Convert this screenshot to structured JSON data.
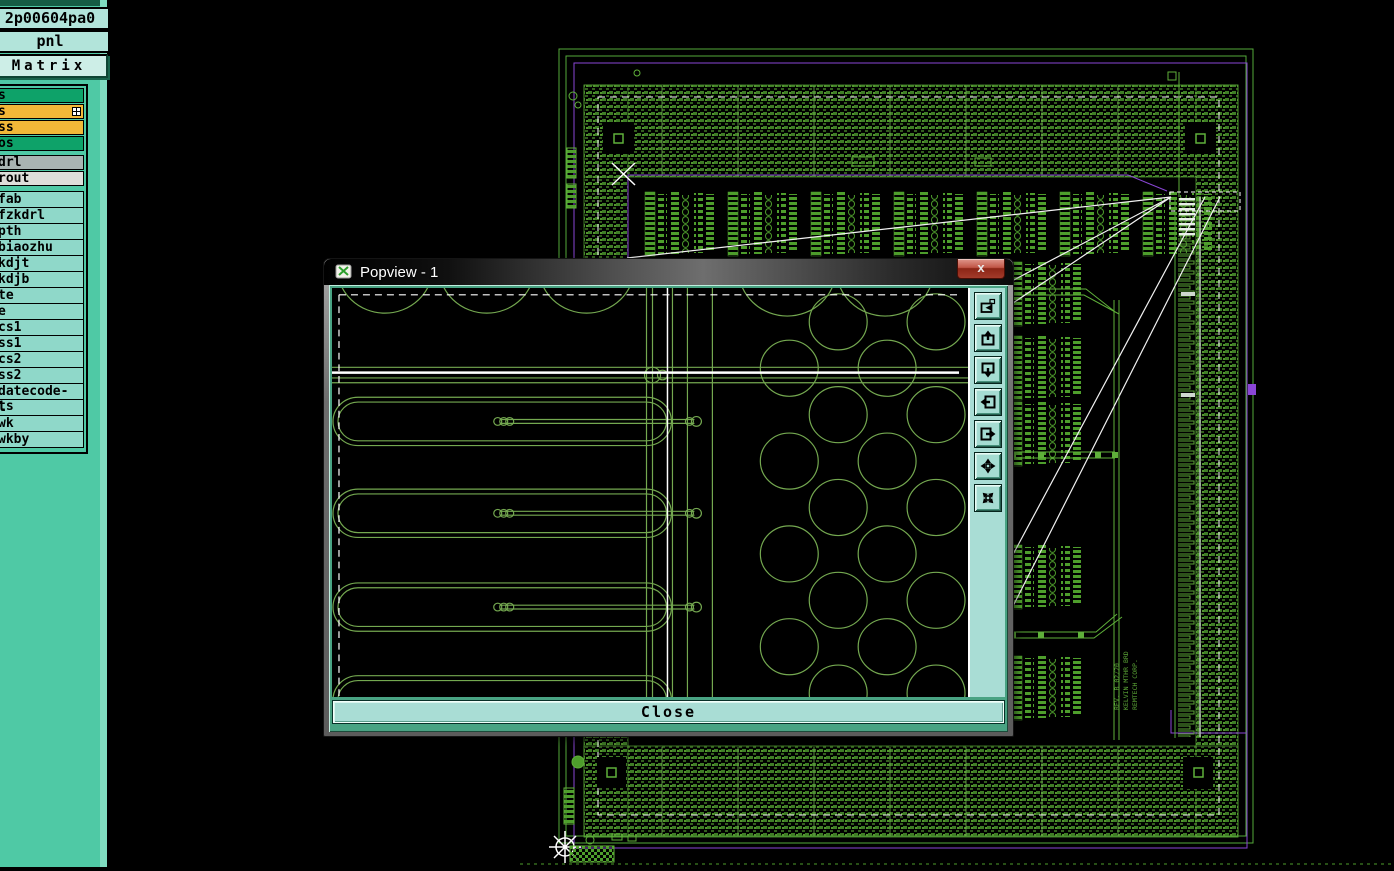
{
  "sidebar": {
    "job_value": "2p00604pa0",
    "step_value": "pnl",
    "matrix_label": "Matrix ...",
    "status_rows": [
      {
        "label": "s",
        "style": "green",
        "has_badge": false
      },
      {
        "label": "s",
        "style": "yellow",
        "has_badge": true
      },
      {
        "label": "ss",
        "style": "yellow",
        "has_badge": false
      },
      {
        "label": "os",
        "style": "green",
        "has_badge": false
      },
      {
        "label": "drl",
        "style": "gray",
        "has_badge": false
      },
      {
        "label": "rout",
        "style": "lightgray",
        "has_badge": false
      }
    ],
    "layer_rows": [
      "fab",
      "fzkdrl",
      "pth",
      "biaozhu",
      "kdjt",
      "kdjb",
      "te",
      "e",
      "cs1",
      "ss1",
      "cs2",
      "ss2",
      "datecode-ts",
      "l",
      "wk",
      "wkby"
    ]
  },
  "popup": {
    "title": "Popview - 1",
    "close_x": "x",
    "close_label": "Close",
    "toolbar": [
      {
        "name": "popview-copy-icon"
      },
      {
        "name": "pan-up-icon"
      },
      {
        "name": "pan-down-icon"
      },
      {
        "name": "pan-left-icon"
      },
      {
        "name": "pan-right-icon"
      },
      {
        "name": "zoom-contract-icon"
      },
      {
        "name": "zoom-expand-icon"
      }
    ]
  },
  "board_text": {
    "line1": "REV. B 02/20",
    "line2": "KELVIN MTHR BRD",
    "line3": "REMTECH CORP."
  },
  "colors": {
    "cad_green": "#5aa336",
    "hatch_green": "#3f7d26",
    "purple": "#8a46d6",
    "sidebar_teal": "#4fc9a5",
    "row_green": "#0ea269",
    "row_yellow": "#f2b838",
    "popup_green": "#74a850",
    "close_red": "#b03a28"
  }
}
